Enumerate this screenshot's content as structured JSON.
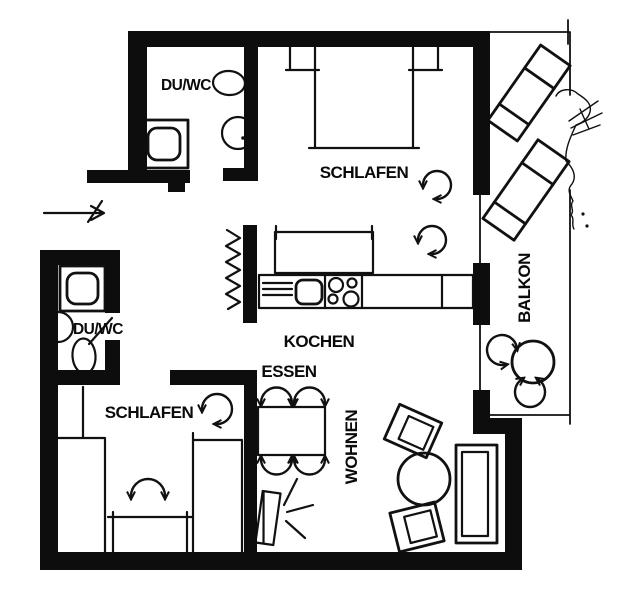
{
  "plan": {
    "labels": {
      "bath_top": "DU/WC",
      "bedroom_top": "SCHLAFEN",
      "kitchen": "KOCHEN",
      "balcony": "BALKON",
      "bath_left": "DU/WC",
      "bedroom_bottom": "SCHLAFEN",
      "dining": "ESSEN",
      "living": "WOHNEN"
    },
    "colors": {
      "ink": "#111111",
      "wall": "#0d0d0d",
      "background": "#ffffff"
    }
  }
}
